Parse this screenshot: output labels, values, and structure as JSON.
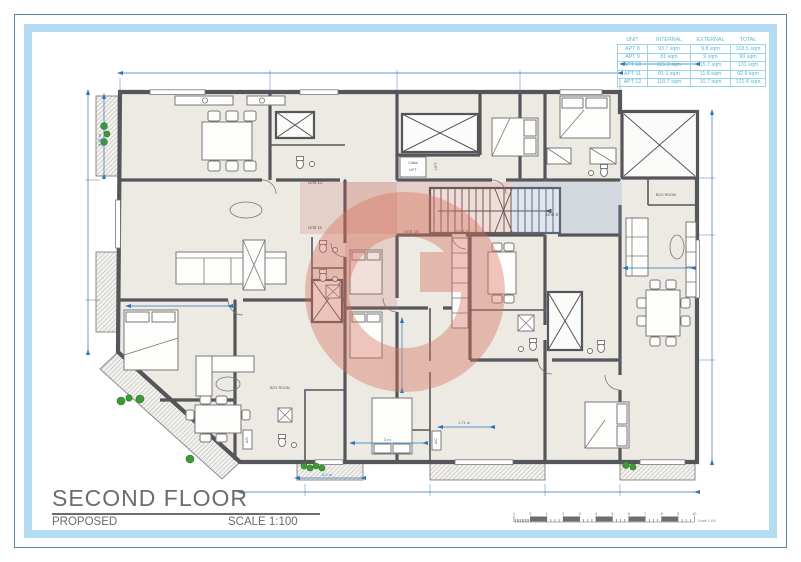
{
  "title_block": {
    "title": "SECOND FLOOR",
    "status": "PROPOSED",
    "scale": "SCALE 1:100"
  },
  "area_table": {
    "headers": [
      "UNIT",
      "INTERNAL",
      "EXTERNAL",
      "TOTAL"
    ],
    "rows": [
      {
        "unit": "APT 8",
        "internal": "93.7 sqm",
        "external": "9.8 sqm",
        "total": "103.5 sqm"
      },
      {
        "unit": "APT 9",
        "internal": "81 sqm",
        "external": "9 sqm",
        "total": "90 sqm"
      },
      {
        "unit": "APT 10",
        "internal": "115.3 sqm",
        "external": "15.7 sqm",
        "total": "131 sqm"
      },
      {
        "unit": "APT 11",
        "internal": "81.1 sqm",
        "external": "11.8 sqm",
        "total": "92.9 sqm"
      },
      {
        "unit": "APT 12",
        "internal": "110.7 sqm",
        "external": "10.7 sqm",
        "total": "121.4 sqm"
      }
    ]
  },
  "scale_bar": {
    "numbers": [
      "1",
      "0",
      "1",
      "2",
      "3",
      "4",
      "5",
      "6",
      "7",
      "8",
      "9",
      "10"
    ],
    "label": "Scale 1:100"
  },
  "plan": {
    "units": [
      {
        "label": "Unit 8"
      },
      {
        "label": "Unit 9"
      },
      {
        "label": "Unit 10"
      },
      {
        "label": "Unit 11"
      },
      {
        "label": "Unit 12"
      }
    ],
    "rooms": {
      "box_room": "BOX ROOM",
      "lift": "LIFT",
      "lift_cabin": "Cabin",
      "ac": "A/C"
    },
    "dimensions": [
      "3.2 m",
      "3 m",
      "1.71 m",
      "6.75 m"
    ]
  },
  "colors": {
    "frame_outer": "#4E8CA4",
    "frame_band": "#B5DCF0",
    "wall": "#55565A",
    "room_fill": "#ECEAE3",
    "dim_blue": "#2E74B8",
    "table_blue": "#5FB4D8",
    "title_grey": "#6A6C6E",
    "watermark_salmon": "#D8705C",
    "wash_red": "#C96A5E",
    "wash_blue": "#7B9CD0",
    "plant_green": "#3E9B33",
    "hatch_grey": "#9A9A9A"
  }
}
